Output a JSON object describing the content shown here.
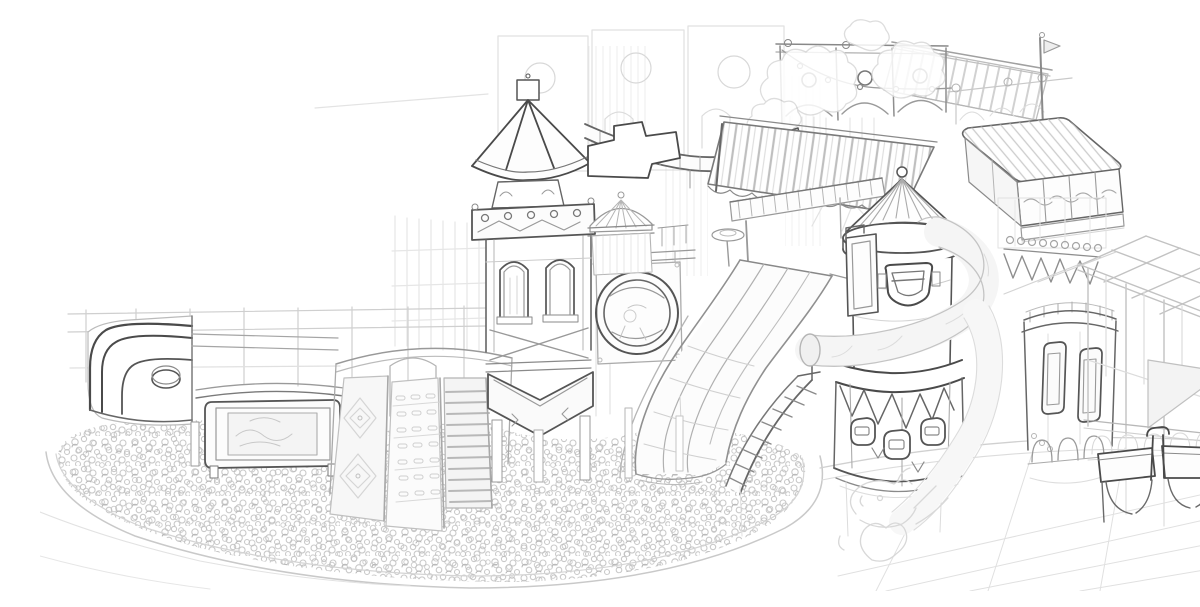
{
  "scene": {
    "description": "Hand-drawn grayscale concept sketch of an indoor children's playground: oval ball pit, triple wavy slide, pagoda climbing tower with arched windows, wheel window, rocket-shaped tower wrapped by a tube slide, striped canopies, hatched deck platform, round turret, caged climbing frame, bench seats and tiled floor",
    "background": "#ffffff",
    "palette": {
      "paper": "#ffffff",
      "ink_dark": "#4a4a4a",
      "ink_mid": "#777777",
      "ink_soft": "#999999",
      "ink_light": "#bbbbbb",
      "ink_faint": "#d5d5d5",
      "ink_ghost": "#e3e3e3"
    },
    "elements": [
      {
        "id": "ball-pit",
        "label": "oval ball pit filled with balls"
      },
      {
        "id": "ball-pit-rim",
        "label": "curved pit rim"
      },
      {
        "id": "floor-tiles",
        "label": "tiled floor"
      },
      {
        "id": "back-fence",
        "label": "background railing fence"
      },
      {
        "id": "left-deck",
        "label": "curved toddler deck with dark rails"
      },
      {
        "id": "play-panel",
        "label": "framed activity panel"
      },
      {
        "id": "climb-barrel",
        "label": "barrel with diamond, holes and ladder climb ramps"
      },
      {
        "id": "pagoda-tower",
        "label": "pagoda-roof tower with arch windows and chevron base"
      },
      {
        "id": "wheel-element",
        "label": "round wheel window"
      },
      {
        "id": "ribbon-walkway",
        "label": "swooping walkway band"
      },
      {
        "id": "wavy-slides",
        "label": "triple wave slide into pit"
      },
      {
        "id": "spiral-stairs",
        "label": "curved staircase"
      },
      {
        "id": "rocket-tower",
        "label": "rocket tower with cone roof, shield emblem, pennants and portholes"
      },
      {
        "id": "tube-slide",
        "label": "light tube slide wrapping the rocket tower"
      },
      {
        "id": "canopy",
        "label": "large striped canopy with balcony"
      },
      {
        "id": "carousel-dome",
        "label": "small striped carousel dome"
      },
      {
        "id": "arch-band",
        "label": "arched trim with round cutouts and light chain"
      },
      {
        "id": "mid-roof",
        "label": "striped roof panel"
      },
      {
        "id": "flag-mast",
        "label": "mast with pennant flag"
      },
      {
        "id": "right-deck",
        "label": "hatched deck platform with wave panels"
      },
      {
        "id": "turret-tower",
        "label": "round turret with windows and arcade"
      },
      {
        "id": "scallop-band",
        "label": "scalloped teeth trim"
      },
      {
        "id": "grid-cage",
        "label": "caged climbing frame"
      },
      {
        "id": "bench",
        "label": "double bench seats with arches"
      },
      {
        "id": "clouds",
        "label": "light cloud doodles"
      },
      {
        "id": "dragon-sketch",
        "label": "faint dragon doodle at tube exit"
      }
    ]
  }
}
